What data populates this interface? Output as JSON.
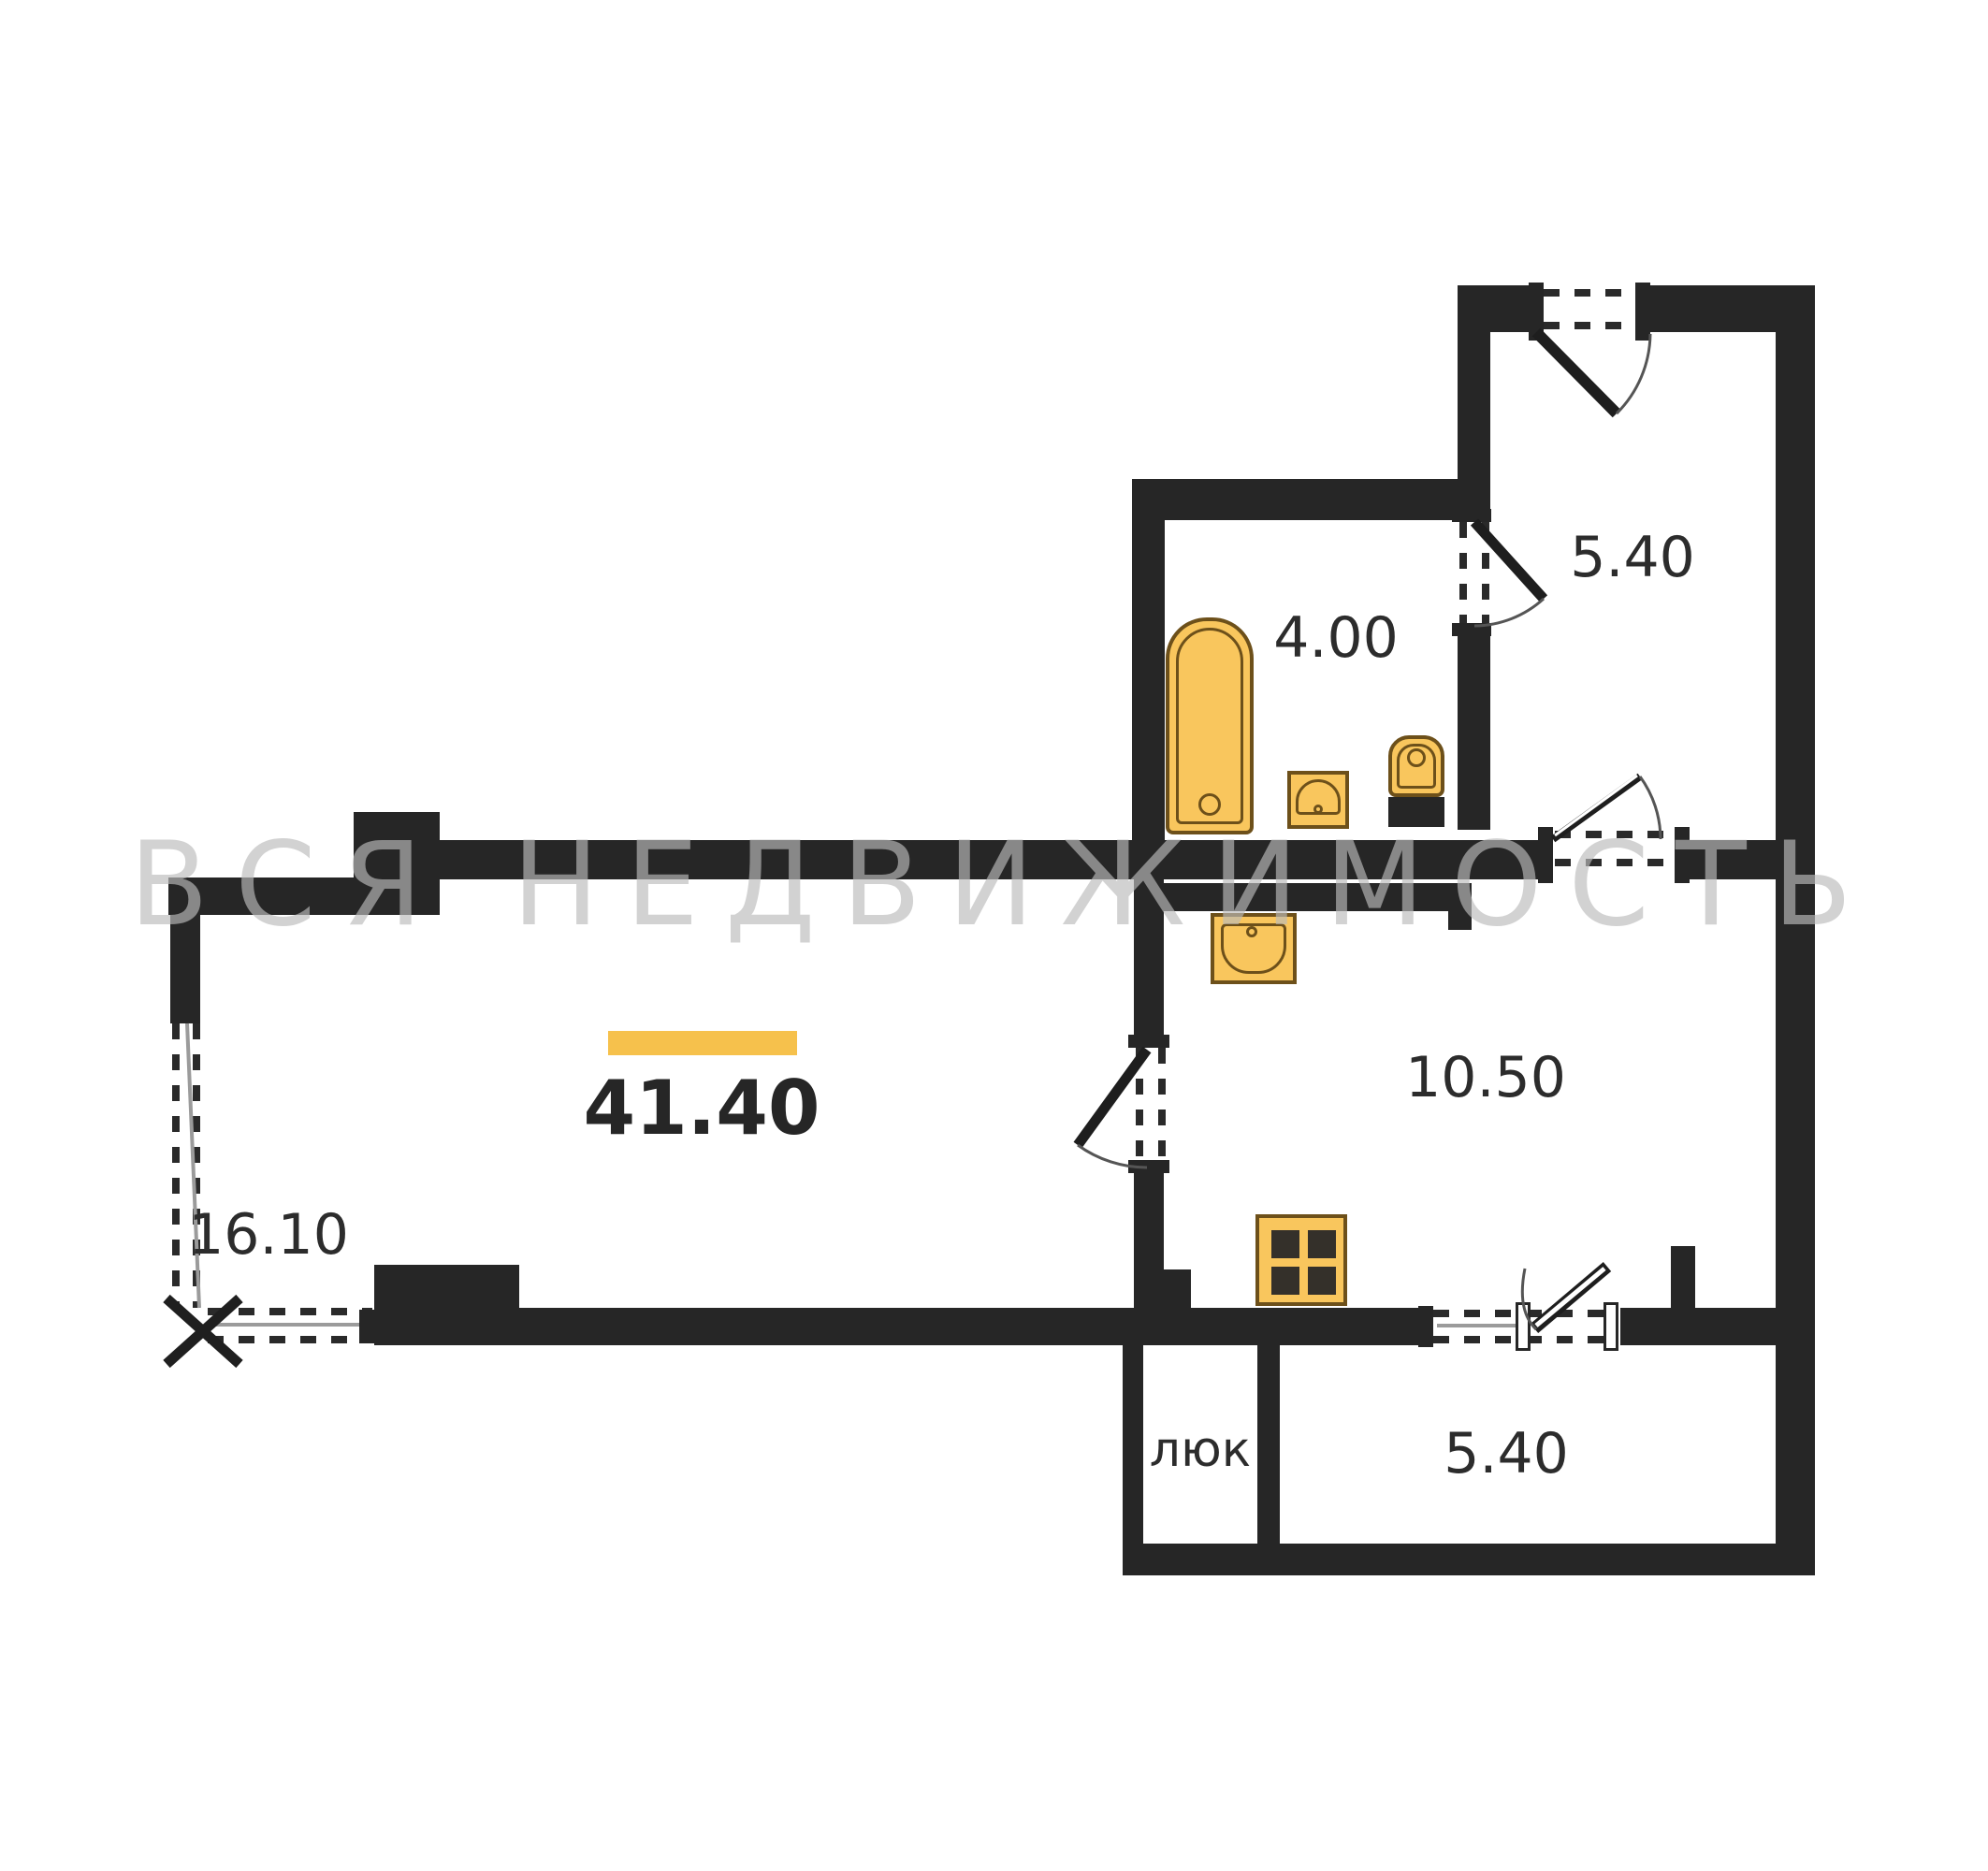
{
  "watermark": {
    "text": "ВСЯ НЕДВИЖИМОСТЬ",
    "color": "#bdbdbd"
  },
  "plan": {
    "type": "apartment-floor-plan",
    "wall_color": "#262626",
    "accent_color": "#f6c14c",
    "fixture_fill": "#f9c65d",
    "fixture_outline": "#6d501a",
    "total_area": "41.40",
    "rooms": [
      {
        "name": "entry-hall",
        "area": "5.40"
      },
      {
        "name": "bathroom",
        "area": "4.00",
        "fixtures": [
          "bathtub",
          "washbasin",
          "toilet"
        ]
      },
      {
        "name": "living-room",
        "area": "41.40"
      },
      {
        "name": "window-bay",
        "area": "16.10"
      },
      {
        "name": "kitchen",
        "area": "10.50",
        "fixtures": [
          "kitchen-sink",
          "stove"
        ]
      },
      {
        "name": "hatch-closet",
        "area": "люк"
      },
      {
        "name": "balcony",
        "area": "5.40"
      }
    ]
  },
  "labels": {
    "total": "41.40",
    "hall": "5.40",
    "bathroom": "4.00",
    "left_room": "16.10",
    "kitchen": "10.50",
    "hatch": "люк",
    "balcony": "5.40"
  }
}
